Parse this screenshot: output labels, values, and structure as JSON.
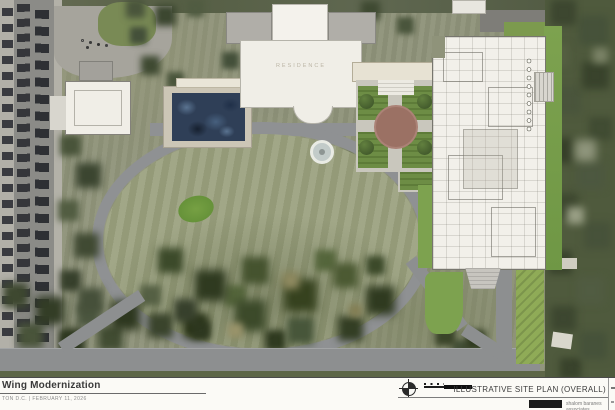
{
  "title_block": {
    "project_title": "Wing Modernization",
    "project_location_date": "TON D.C.   |   FEBRUARY 11, 2026",
    "sheet_title": "ILLUSTRATIVE SITE PLAN (OVERALL)",
    "firm_name": "shalom baranes associates"
  },
  "plan_labels": {
    "residence": "RESIDENCE"
  },
  "icons": {
    "north_arrow": "north-arrow-compass",
    "scale_bar": "graphic-scale-bar",
    "firm_logo": "dark-logo-box"
  },
  "colors": {
    "road_gray": "#8d8f90",
    "rendered_lawn_green": "#7da24f",
    "plan_paper": "#f2f0ea",
    "garden_brick": "#9b7164",
    "pool_roof_blue": "#2f3f57",
    "tree_dark_green": "#3d4730"
  }
}
